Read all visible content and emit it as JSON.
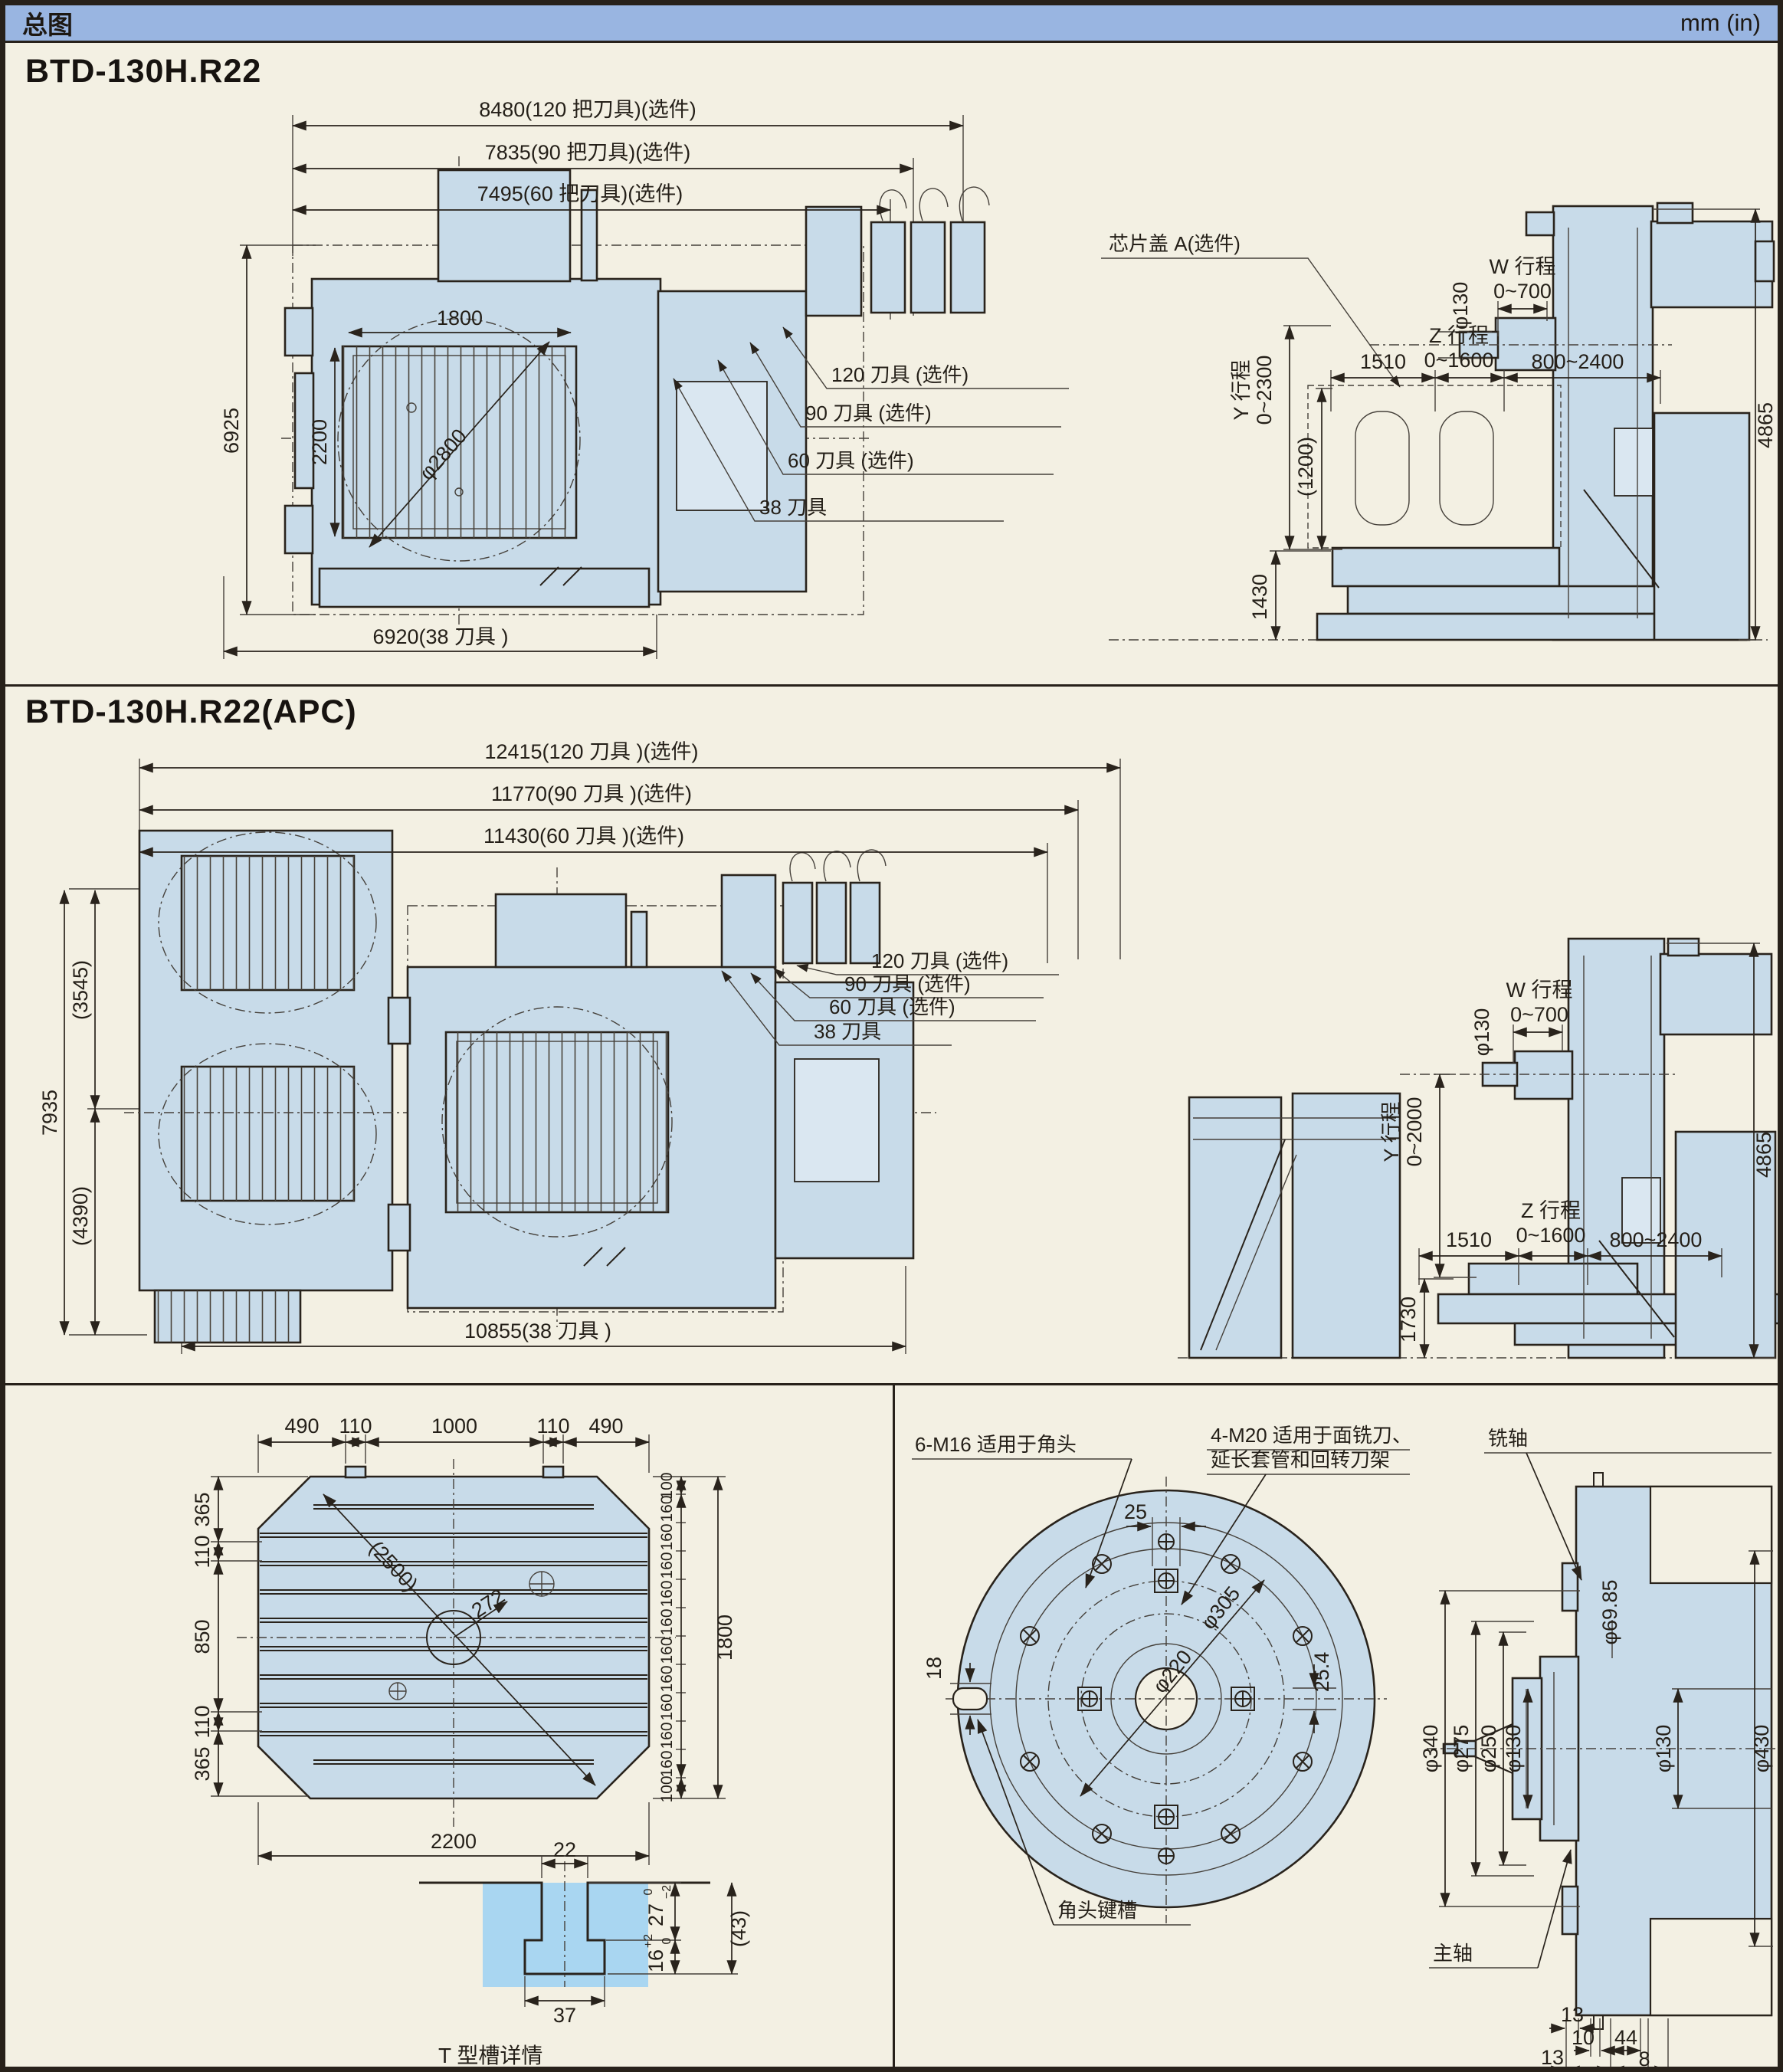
{
  "colors": {
    "header_blue": "#99b5e1",
    "machine_fill": "#c8dbe9",
    "page_bg": "#f3f0e3",
    "line": "#29231c",
    "tslot_highlight": "#a9d6f1"
  },
  "header": {
    "title": "总图",
    "units": "mm (in)"
  },
  "s1": {
    "title": "BTD-130H.R22",
    "plan": {
      "dim_top1": "8480(120 把刀具)(选件)",
      "dim_top2": "7835(90 把刀具)(选件)",
      "dim_top3": "7495(60 把刀具)(选件)",
      "dim_left": "6925",
      "dim_width": "1800",
      "dim_height": "2200",
      "dim_diag": "φ2800",
      "dim_bottom": "6920(38 刀具 )",
      "tools": [
        "120 刀具 (选件)",
        "90 刀具 (选件)",
        "60 刀具 (选件)",
        "38 刀具"
      ]
    },
    "side": {
      "chip_cover": "芯片盖 A(选件)",
      "w_label": "W 行程",
      "w_value": "0~700",
      "dia130": "φ130",
      "y_label": "Y 行程",
      "y_value": "0~2300",
      "z_label": "Z 行程",
      "z_value": "0~1600",
      "dim_1510": "1510",
      "dim_800_2400": "800~2400",
      "dim_1200": "(1200)",
      "dim_1430": "1430",
      "dim_4865": "4865"
    }
  },
  "s2": {
    "title": "BTD-130H.R22(APC)",
    "plan": {
      "dim_top1": "12415(120 刀具 )(选件)",
      "dim_top2": "11770(90 刀具 )(选件)",
      "dim_top3": "11430(60 刀具 )(选件)",
      "dim_7935": "7935",
      "dim_3545": "(3545)",
      "dim_4390": "(4390)",
      "dim_bottom": "10855(38 刀具 )",
      "tools": [
        "120 刀具 (选件)",
        "90 刀具 (选件)",
        "60 刀具 (选件)",
        "38 刀具"
      ]
    },
    "side": {
      "w_label": "W 行程",
      "w_value": "0~700",
      "dia130": "φ130",
      "y_label": "Y 行程",
      "y_value": "0~2000",
      "z_label": "Z 行程",
      "z_value": "0~1600",
      "dim_1510": "1510",
      "dim_800_2400": "800~2400",
      "dim_1730": "1730",
      "dim_4865": "4865"
    }
  },
  "s3": {
    "table": {
      "top_dims": [
        "490",
        "110",
        "1000",
        "110",
        "490"
      ],
      "left_dims": [
        "365",
        "110",
        "850",
        "110",
        "365"
      ],
      "right_chain": [
        "100",
        "160",
        "160",
        "160",
        "160",
        "160",
        "160",
        "160",
        "160",
        "160",
        "160",
        "100"
      ],
      "right_total": "1800",
      "diag": "(2500)",
      "radius": "272",
      "bottom": "2200"
    },
    "tslot": {
      "w_top": "22",
      "w_bottom": "37",
      "d27": "27",
      "d27_hi": "0",
      "d27_lo": "−2",
      "d43": "(43)",
      "d16": "16",
      "d16_hi": "+2",
      "d16_lo": "0",
      "caption": "T 型槽详情"
    },
    "flange": {
      "label_m16": "6-M16 适用于角头",
      "label_m20a": "4-M20 适用于面铣刀、",
      "label_m20b": "延长套管和回转刀架",
      "dim_25": "25",
      "dia305": "φ305",
      "dia220": "φ220",
      "dim_254": "25.4",
      "dim_18": "18",
      "keyway": "角头键槽"
    },
    "spindle": {
      "mill_axis": "铣轴",
      "main_spindle": "主轴",
      "dia6985": "φ69.85",
      "dia340": "φ340",
      "dia275": "φ275",
      "dia250": "φ250",
      "dia130_left": "φ130",
      "dia130_right": "φ130",
      "dia430": "φ430",
      "bottom_dims": [
        "13",
        "10",
        "44",
        "8",
        "13",
        "48",
        "62"
      ]
    }
  }
}
